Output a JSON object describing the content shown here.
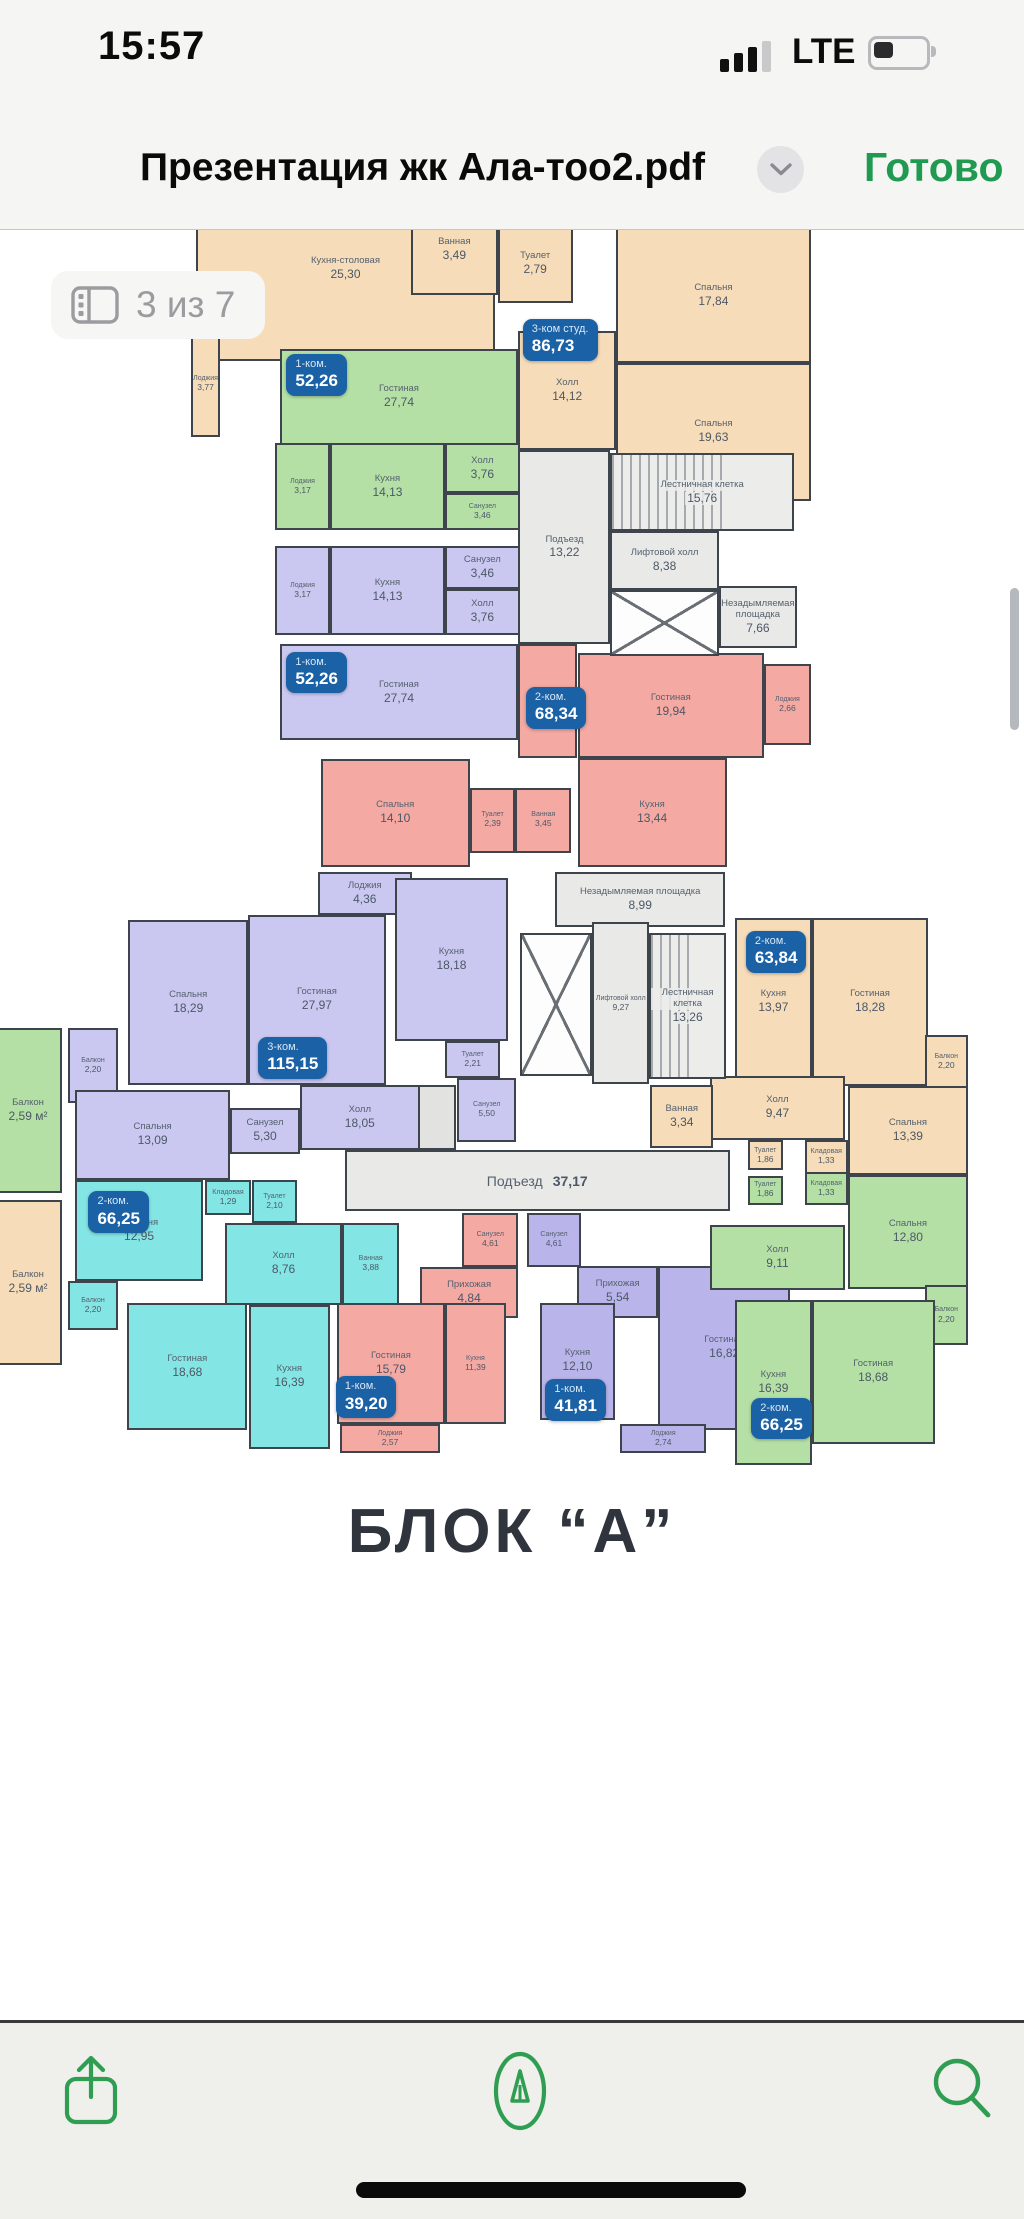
{
  "status_bar": {
    "time": "15:57",
    "network": "LTE"
  },
  "title_bar": {
    "title": "Презентация жк Ала-тоо2.pdf",
    "action": "Готово"
  },
  "page_indicator": "3 из 7",
  "footer_title": "БЛОК “А”",
  "colors": {
    "accent_green": "#1f9a50",
    "badge_blue": "#1a61a5",
    "wall": "#3e444b"
  },
  "plans": {
    "top": {
      "rooms": [
        {
          "n": "Кухня-столовая",
          "a": "25,30",
          "c": "peach",
          "x": 1.0,
          "y": 1.2,
          "w": 48.0,
          "h": 26.0
        },
        {
          "n": "Ванная",
          "a": "3,49",
          "c": "peach",
          "x": 35.5,
          "y": 5.0,
          "w": 14.0,
          "h": 13.0
        },
        {
          "n": "Туалет",
          "a": "2,79",
          "c": "peach",
          "x": 49.5,
          "y": 8.0,
          "w": 12.0,
          "h": 11.0
        },
        {
          "n": "Спальня",
          "a": "17,84",
          "c": "peach",
          "x": 68.5,
          "y": 8.5,
          "w": 31.3,
          "h": 19.0
        },
        {
          "n": "Спальня",
          "a": "19,63",
          "c": "peach",
          "x": 68.5,
          "y": 27.5,
          "w": 31.3,
          "h": 19.5
        },
        {
          "n": "Холл",
          "a": "14,12",
          "c": "peach",
          "x": 52.8,
          "y": 23.0,
          "w": 15.7,
          "h": 16.8
        },
        {
          "n": "Лоджия",
          "a": "3,77",
          "c": "peach",
          "x": 0.2,
          "y": 23.0,
          "w": 4.6,
          "h": 15.0
        },
        {
          "n": "Гостиная",
          "a": "27,74",
          "c": "green",
          "x": 14.5,
          "y": 25.5,
          "w": 38.2,
          "h": 13.6
        },
        {
          "n": "Лоджия",
          "a": "3,17",
          "c": "green",
          "x": 13.7,
          "y": 38.9,
          "w": 8.8,
          "h": 12.2
        },
        {
          "n": "Кухня",
          "a": "14,13",
          "c": "green",
          "x": 22.5,
          "y": 38.9,
          "w": 18.5,
          "h": 12.2
        },
        {
          "n": "Холл",
          "a": "3,76",
          "c": "green",
          "x": 41.0,
          "y": 38.9,
          "w": 12.0,
          "h": 7.0
        },
        {
          "n": "Санузел",
          "a": "3,46",
          "c": "green",
          "x": 41.0,
          "y": 45.9,
          "w": 12.0,
          "h": 5.2
        },
        {
          "n": "Лоджия",
          "a": "3,17",
          "c": "lav",
          "x": 13.7,
          "y": 53.4,
          "w": 8.8,
          "h": 12.6
        },
        {
          "n": "Кухня",
          "a": "14,13",
          "c": "lav",
          "x": 22.5,
          "y": 53.4,
          "w": 18.5,
          "h": 12.6
        },
        {
          "n": "Санузел",
          "a": "3,46",
          "c": "lav",
          "x": 41.0,
          "y": 53.4,
          "w": 12.0,
          "h": 6.0
        },
        {
          "n": "Холл",
          "a": "3,76",
          "c": "lav",
          "x": 41.0,
          "y": 59.4,
          "w": 12.0,
          "h": 6.6
        },
        {
          "n": "Гостиная",
          "a": "27,74",
          "c": "lav",
          "x": 14.5,
          "y": 67.3,
          "w": 38.2,
          "h": 13.5
        },
        {
          "n": "Холл",
          "a": "12,36",
          "c": "pink",
          "x": 52.8,
          "y": 67.3,
          "w": 9.5,
          "h": 16.0
        },
        {
          "n": "Гостиная",
          "a": "19,94",
          "c": "pink",
          "x": 62.3,
          "y": 68.5,
          "w": 30.0,
          "h": 14.8
        },
        {
          "n": "Лоджия",
          "a": "2,66",
          "c": "pink",
          "x": 92.3,
          "y": 70.0,
          "w": 7.5,
          "h": 11.5
        },
        {
          "n": "Спальня",
          "a": "14,10",
          "c": "pink",
          "x": 21.0,
          "y": 83.5,
          "w": 24.0,
          "h": 15.2
        },
        {
          "n": "Туалет",
          "a": "2,39",
          "c": "pink",
          "x": 45.0,
          "y": 87.5,
          "w": 7.3,
          "h": 9.2
        },
        {
          "n": "Ванная",
          "a": "3,45",
          "c": "pink",
          "x": 52.3,
          "y": 87.5,
          "w": 9.0,
          "h": 9.2
        },
        {
          "n": "Кухня",
          "a": "13,44",
          "c": "pink",
          "x": 62.3,
          "y": 83.3,
          "w": 24.0,
          "h": 15.4
        },
        {
          "n": "Подъезд",
          "a": "13,22",
          "c": "gray",
          "x": 52.8,
          "y": 39.8,
          "w": 14.8,
          "h": 27.5
        },
        {
          "n": "Лестничная клетка",
          "a": "15,76",
          "c": "gray",
          "f": "stairs",
          "x": 67.6,
          "y": 40.3,
          "w": 29.5,
          "h": 11.0
        },
        {
          "n": "Лифтовой холл",
          "a": "8,38",
          "c": "gray",
          "x": 67.6,
          "y": 51.3,
          "w": 17.4,
          "h": 8.3
        },
        {
          "c": "gray",
          "f": "shaft",
          "x": 67.6,
          "y": 59.6,
          "w": 17.4,
          "h": 9.3
        },
        {
          "n": "Незадымляемая площадка",
          "a": "7,66",
          "c": "gray",
          "x": 85.0,
          "y": 59.0,
          "w": 12.6,
          "h": 8.8
        }
      ],
      "badges": [
        {
          "t": "3-ком студ.",
          "v": "86,73",
          "x": 53.5,
          "y": 21.3
        },
        {
          "t": "1-ком.",
          "v": "52,26",
          "x": 15.5,
          "y": 26.3
        },
        {
          "t": "1-ком.",
          "v": "52,26",
          "x": 15.5,
          "y": 68.3
        },
        {
          "t": "2-ком.",
          "v": "68,34",
          "x": 54.0,
          "y": 73.3
        }
      ]
    },
    "bottom": {
      "rooms": [
        {
          "n": "Балкон",
          "a": "2,20",
          "c": "lav",
          "x": 0.3,
          "y": 26.0,
          "w": 5.6,
          "h": 11.3
        },
        {
          "n": "Спальня",
          "a": "18,29",
          "c": "lav",
          "x": 7.0,
          "y": 9.8,
          "w": 13.3,
          "h": 24.8
        },
        {
          "n": "Гостиная",
          "a": "27,97",
          "c": "lav",
          "x": 20.3,
          "y": 9.0,
          "w": 15.2,
          "h": 25.6
        },
        {
          "n": "Лоджия",
          "a": "4,36",
          "c": "lav",
          "x": 28.0,
          "y": 2.6,
          "w": 10.4,
          "h": 6.4
        },
        {
          "n": "Кухня",
          "a": "18,18",
          "c": "lav",
          "x": 36.5,
          "y": 3.4,
          "w": 12.6,
          "h": 24.6
        },
        {
          "n": "Туалет",
          "a": "2,21",
          "c": "lav",
          "x": 42.1,
          "y": 28.0,
          "w": 6.1,
          "h": 5.5
        },
        {
          "c": "gray2",
          "f": "blank",
          "x": 31.0,
          "y": 34.6,
          "w": 12.3,
          "h": 9.8
        },
        {
          "n": "Холл",
          "a": "18,05",
          "c": "lav",
          "x": 26.0,
          "y": 34.6,
          "w": 13.3,
          "h": 9.8
        },
        {
          "n": "Санузел",
          "a": "5,50",
          "c": "lav",
          "x": 43.4,
          "y": 33.5,
          "w": 6.6,
          "h": 9.7
        },
        {
          "n": "Санузел",
          "a": "5,30",
          "c": "lav",
          "x": 18.3,
          "y": 38.0,
          "w": 7.7,
          "h": 7.0
        },
        {
          "n": "Спальня",
          "a": "13,09",
          "c": "lav",
          "x": 1.1,
          "y": 35.3,
          "w": 17.2,
          "h": 13.6
        },
        {
          "n": "Спальня",
          "a": "12,95",
          "c": "cyan",
          "x": 1.1,
          "y": 48.9,
          "w": 14.2,
          "h": 15.1
        },
        {
          "n": "Кладовая",
          "a": "1,29",
          "c": "cyan",
          "x": 15.5,
          "y": 48.9,
          "w": 5.1,
          "h": 5.3
        },
        {
          "n": "Туалет",
          "a": "2,10",
          "c": "cyan",
          "x": 20.7,
          "y": 48.9,
          "w": 5.0,
          "h": 6.4
        },
        {
          "n": "Холл",
          "a": "8,76",
          "c": "cyan",
          "x": 17.7,
          "y": 55.3,
          "w": 13.0,
          "h": 12.3
        },
        {
          "n": "Ванная",
          "a": "3,88",
          "c": "cyan",
          "x": 30.7,
          "y": 55.3,
          "w": 6.3,
          "h": 12.3
        },
        {
          "n": "Балкон",
          "a": "2,20",
          "c": "cyan",
          "x": 0.3,
          "y": 64.0,
          "w": 5.6,
          "h": 7.5
        },
        {
          "n": "Гостиная",
          "a": "18,68",
          "c": "cyan",
          "x": 6.9,
          "y": 67.4,
          "w": 13.3,
          "h": 19.0
        },
        {
          "n": "Кухня",
          "a": "16,39",
          "c": "cyan",
          "x": 20.4,
          "y": 67.7,
          "w": 8.9,
          "h": 21.6
        },
        {
          "n": "Санузел",
          "a": "4,61",
          "c": "pink",
          "x": 44.0,
          "y": 53.8,
          "w": 6.2,
          "h": 8.2
        },
        {
          "n": "Прихожая",
          "a": "4,84",
          "c": "pink",
          "x": 39.3,
          "y": 62.0,
          "w": 10.9,
          "h": 7.6
        },
        {
          "n": "Гостиная",
          "a": "15,79",
          "c": "pink",
          "x": 30.1,
          "y": 67.3,
          "w": 12.0,
          "h": 18.3
        },
        {
          "n": "Кухня",
          "a": "11,39",
          "c": "pink",
          "x": 42.1,
          "y": 67.3,
          "w": 6.7,
          "h": 18.3
        },
        {
          "n": "Лоджия",
          "a": "2,57",
          "c": "pink",
          "x": 30.5,
          "y": 85.6,
          "w": 11.0,
          "h": 4.4
        },
        {
          "n": "Санузел",
          "a": "4,61",
          "c": "purple",
          "x": 51.2,
          "y": 53.8,
          "w": 5.9,
          "h": 8.2
        },
        {
          "n": "Прихожая",
          "a": "5,54",
          "c": "purple",
          "x": 56.7,
          "y": 61.8,
          "w": 9.0,
          "h": 7.8
        },
        {
          "n": "Кухня",
          "a": "12,10",
          "c": "purple",
          "x": 52.6,
          "y": 67.3,
          "w": 8.3,
          "h": 17.6
        },
        {
          "n": "Гостиная",
          "a": "16,82",
          "c": "purple",
          "x": 65.7,
          "y": 61.8,
          "w": 14.6,
          "h": 24.6
        },
        {
          "n": "Лоджия",
          "a": "2,74",
          "c": "purple",
          "x": 61.5,
          "y": 85.6,
          "w": 9.5,
          "h": 4.4
        },
        {
          "n": "Туалет",
          "a": "1,86",
          "c": "green",
          "x": 75.6,
          "y": 48.2,
          "w": 3.9,
          "h": 4.4
        },
        {
          "n": "Кладовая",
          "a": "1,33",
          "c": "green",
          "x": 81.9,
          "y": 47.7,
          "w": 4.8,
          "h": 4.9
        },
        {
          "n": "Спальня",
          "a": "12,80",
          "c": "green",
          "x": 86.7,
          "y": 48.1,
          "w": 13.3,
          "h": 17.2
        },
        {
          "n": "Холл",
          "a": "9,11",
          "c": "green",
          "x": 71.4,
          "y": 55.7,
          "w": 15.0,
          "h": 9.7
        },
        {
          "n": "Балкон",
          "a": "2,20",
          "c": "green",
          "x": 95.2,
          "y": 64.7,
          "w": 4.8,
          "h": 9.0
        },
        {
          "n": "Кухня",
          "a": "16,39",
          "c": "green",
          "x": 74.2,
          "y": 66.9,
          "w": 8.5,
          "h": 24.8
        },
        {
          "n": "Гостиная",
          "a": "18,68",
          "c": "green",
          "x": 82.7,
          "y": 66.9,
          "w": 13.6,
          "h": 21.7
        },
        {
          "n": "Кухня",
          "a": "13,97",
          "c": "peach",
          "x": 74.2,
          "y": 9.5,
          "w": 8.5,
          "h": 25.2
        },
        {
          "n": "Гостиная",
          "a": "18,28",
          "c": "peach",
          "x": 82.7,
          "y": 9.5,
          "w": 12.9,
          "h": 25.2
        },
        {
          "n": "Балкон",
          "a": "2,20",
          "c": "peach",
          "x": 95.2,
          "y": 27.0,
          "w": 4.8,
          "h": 8.3
        },
        {
          "n": "Холл",
          "a": "9,47",
          "c": "peach",
          "x": 71.4,
          "y": 33.2,
          "w": 15.0,
          "h": 9.7
        },
        {
          "n": "Туалет",
          "a": "1,86",
          "c": "peach",
          "x": 75.6,
          "y": 42.9,
          "w": 3.9,
          "h": 4.5
        },
        {
          "n": "Кладовая",
          "a": "1,33",
          "c": "peach",
          "x": 81.9,
          "y": 42.9,
          "w": 4.8,
          "h": 5.0
        },
        {
          "n": "Спальня",
          "a": "13,39",
          "c": "peach",
          "x": 86.7,
          "y": 34.7,
          "w": 13.3,
          "h": 13.4
        },
        {
          "n": "Ванная",
          "a": "3,34",
          "c": "peach",
          "x": 64.8,
          "y": 34.6,
          "w": 7.0,
          "h": 9.4
        },
        {
          "n": "Незадымляемая площадка",
          "a": "8,99",
          "c": "gray",
          "x": 54.3,
          "y": 2.6,
          "w": 18.8,
          "h": 8.3
        },
        {
          "c": "gray",
          "f": "shaft",
          "x": 50.4,
          "y": 11.7,
          "w": 8.0,
          "h": 21.5
        },
        {
          "n": "Лифтовой холл",
          "a": "9,27",
          "c": "gray",
          "x": 58.4,
          "y": 10.1,
          "w": 6.3,
          "h": 24.4
        },
        {
          "n": "Лестничная клетка",
          "a": "13,26",
          "c": "gray",
          "f": "stairs",
          "x": 64.7,
          "y": 11.7,
          "w": 8.5,
          "h": 22.0
        },
        {
          "n": "Подъезд",
          "a": "37,17",
          "c": "gray",
          "inline": true,
          "x": 31.0,
          "y": 44.4,
          "w": 42.6,
          "h": 9.2
        }
      ],
      "badges": [
        {
          "t": "3-ком.",
          "v": "115,15",
          "x": 21.4,
          "y": 27.4
        },
        {
          "t": "2-ком.",
          "v": "66,25",
          "x": 2.6,
          "y": 50.6
        },
        {
          "t": "1-ком.",
          "v": "39,20",
          "x": 30.0,
          "y": 78.4
        },
        {
          "t": "1-ком.",
          "v": "41,81",
          "x": 53.2,
          "y": 78.8
        },
        {
          "t": "2-ком.",
          "v": "66,25",
          "x": 76.0,
          "y": 81.6
        },
        {
          "t": "2-ком.",
          "v": "63,84",
          "x": 75.4,
          "y": 11.4
        }
      ]
    },
    "neighbor": {
      "rooms": [
        {
          "n": "Балкон",
          "a": "2,59 м²",
          "c": "green",
          "x": 0,
          "y": 0,
          "w": 100,
          "h": 49
        },
        {
          "n": "Балкон",
          "a": "2,59 м²",
          "c": "peach",
          "x": 0,
          "y": 51,
          "w": 100,
          "h": 49
        }
      ],
      "badges": []
    }
  }
}
